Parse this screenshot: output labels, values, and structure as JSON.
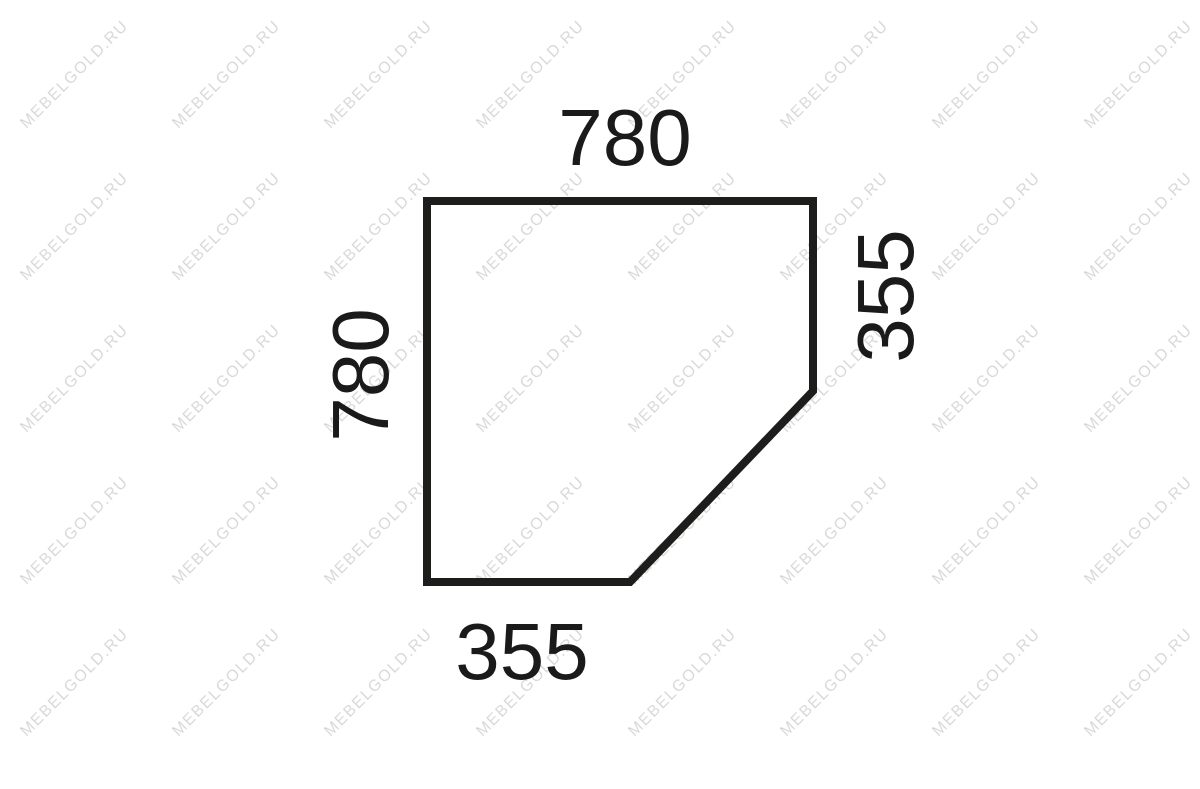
{
  "diagram": {
    "title": "corner-panel-dimension-drawing",
    "outline_color": "#1d1d1b",
    "text_color": "#1a1a1a",
    "dimensions": {
      "top": "780",
      "left": "780",
      "right": "355",
      "bottom": "355"
    }
  },
  "watermark": {
    "text": "MEBELGOLD.RU",
    "color": "#d9d9d9"
  }
}
